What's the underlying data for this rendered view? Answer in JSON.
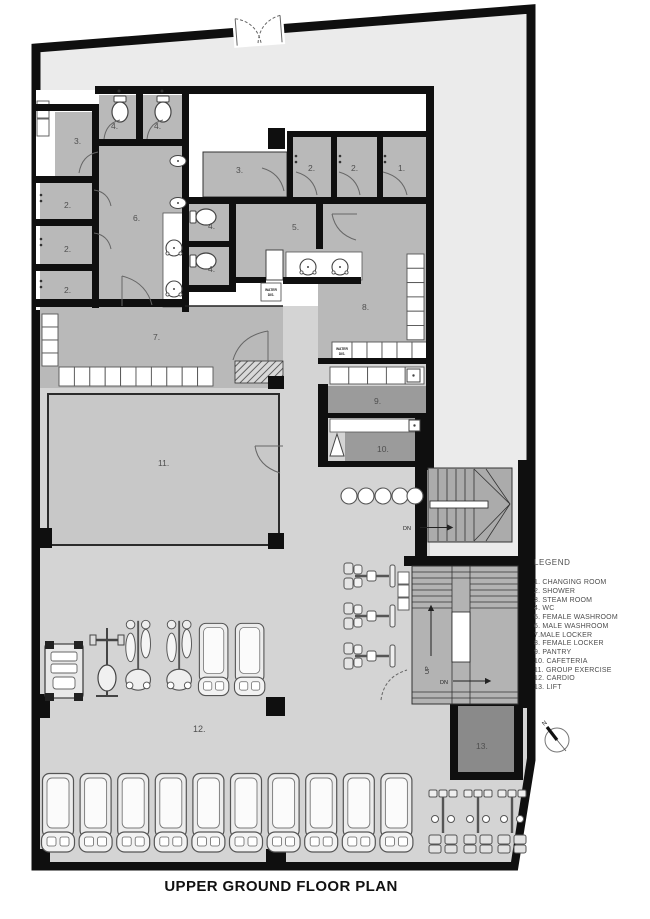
{
  "title": "UPPER GROUND FLOOR PLAN",
  "legend": {
    "heading": "LEGEND",
    "items": [
      "1. CHANGING ROOM",
      "2. SHOWER",
      "3. STEAM ROOM",
      "4. WC",
      "5. FEMALE WASHROOM",
      "6. MALE WASHROOM",
      "7.MALE LOCKER",
      "8. FEMALE LOCKER",
      "9. PANTRY",
      "10. CAFETERIA",
      "11. GROUP EXERCISE",
      "12. CARDIO",
      "13. LIFT"
    ]
  },
  "rooms": {
    "r1": "1.",
    "r2": "2.",
    "r3": "3.",
    "r4": "4.",
    "r5": "5.",
    "r6": "6.",
    "r7": "7.",
    "r8": "8.",
    "r9": "9.",
    "r10": "10.",
    "r11": "11.",
    "r12": "12.",
    "r13": "13."
  },
  "annotations": {
    "water_dispenser_line1": "WATER",
    "water_dispenser_line2": "DIS.",
    "stairs_up": "UP",
    "stairs_down": "DN",
    "north": "N"
  },
  "colors": {
    "wall": "#0f0f0f",
    "room_fill": "#b9b9b9",
    "gym_floor": "#d4d4d4",
    "site_band": "#ebebeb",
    "dark_room_fill": "#9b9b9b",
    "lift_fill": "#8a8a8a",
    "stair_fill": "#b0b0b0",
    "background": "#ffffff"
  }
}
